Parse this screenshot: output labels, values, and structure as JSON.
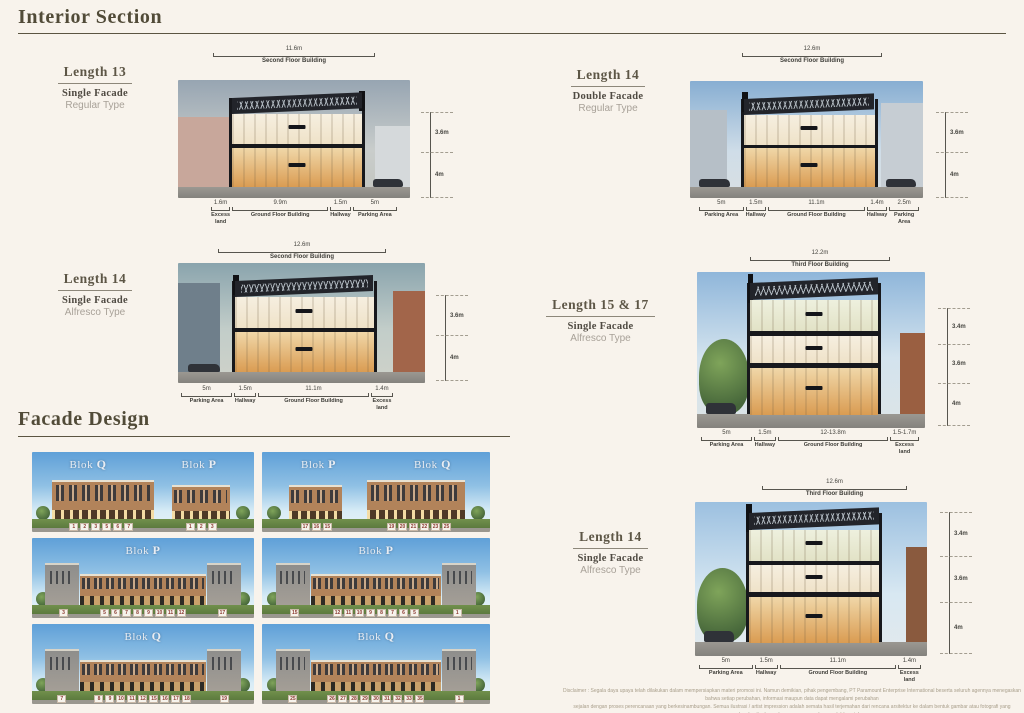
{
  "page": {
    "heading_interior": "Interior Section",
    "heading_facade": "Facade Design",
    "disclaimer_line1": "Disclaimer :  Segala daya upaya telah dilakukan dalam mempersiapkan materi promosi ini. Namun demikian, pihak pengembang, PT Paramount Enterprise International beserta seluruh agennya menegaskan bahwa setiap perubahan, informasi maupun data dapat mengalami perubahan",
    "disclaimer_line2": "sejalan dengan proses perencanaan yang berkesinambungan. Semua ilustrasi / artist impression adalah semata hasil terjemahan dari rencana arsitektur ke dalam bentuk gambar atau fotografi yang merupakan hasil rekaan dengan menggunakan model / contoh."
  },
  "colors": {
    "page_background": "#f8f3ec",
    "heading_text": "#514b38",
    "marker_text": "#8b3a31",
    "sky_blue": "#5fa0d8",
    "grass_green": "#5c7a3e",
    "building_tan": "#b2835a"
  },
  "sections": [
    {
      "length": "Length 13",
      "facade": "Single Facade",
      "type": "Regular Type",
      "top_dim": "11.6m",
      "top_label": "Second Floor Building",
      "right_dims": [
        "3.6m",
        "4m"
      ],
      "bottom": [
        {
          "v": "1.6m",
          "l": "Excess land"
        },
        {
          "v": "9.9m",
          "l": "Ground Floor Building"
        },
        {
          "v": "1.5m",
          "l": "Hallway"
        },
        {
          "v": "5m",
          "l": "Parking Area"
        }
      ]
    },
    {
      "length": "Length 14",
      "facade": "Single Facade",
      "type": "Alfresco Type",
      "top_dim": "12.6m",
      "top_label": "Second Floor Building",
      "right_dims": [
        "3.6m",
        "4m"
      ],
      "bottom": [
        {
          "v": "5m",
          "l": "Parking Area"
        },
        {
          "v": "1.5m",
          "l": "Hallway"
        },
        {
          "v": "11.1m",
          "l": "Ground Floor Building"
        },
        {
          "v": "1.4m",
          "l": "Excess land"
        }
      ]
    },
    {
      "length": "Length 14",
      "facade": "Double Facade",
      "type": "Regular Type",
      "top_dim": "12.6m",
      "top_label": "Second Floor Building",
      "right_dims": [
        "3.6m",
        "4m"
      ],
      "bottom": [
        {
          "v": "5m",
          "l": "Parking Area"
        },
        {
          "v": "1.5m",
          "l": "Hallway"
        },
        {
          "v": "11.1m",
          "l": "Ground Floor Building"
        },
        {
          "v": "1.4m",
          "l": "Hallway"
        },
        {
          "v": "2.5m",
          "l": "Parking Area"
        }
      ]
    },
    {
      "length": "Length 15 & 17",
      "facade": "Single Facade",
      "type": "Alfresco Type",
      "top_dim": "12.2m",
      "top_label": "Third Floor Building",
      "right_dims": [
        "3.4m",
        "3.6m",
        "4m"
      ],
      "bottom": [
        {
          "v": "5m",
          "l": "Parking Area"
        },
        {
          "v": "1.5m",
          "l": "Hallway"
        },
        {
          "v": "12-13.8m",
          "l": "Ground Floor Building"
        },
        {
          "v": "1.5-1.7m",
          "l": "Excess land"
        }
      ]
    },
    {
      "length": "Length 14",
      "facade": "Single Facade",
      "type": "Alfresco Type",
      "top_dim": "12.6m",
      "top_label": "Third Floor Building",
      "right_dims": [
        "3.4m",
        "3.6m",
        "4m"
      ],
      "bottom": [
        {
          "v": "5m",
          "l": "Parking Area"
        },
        {
          "v": "1.5m",
          "l": "Hallway"
        },
        {
          "v": "11.1m",
          "l": "Ground Floor Building"
        },
        {
          "v": "1.4m",
          "l": "Excess land"
        }
      ]
    }
  ],
  "facade": {
    "cards": [
      {
        "bloks": [
          {
            "prefix": "Blok ",
            "letter": "Q"
          },
          {
            "prefix": "Blok ",
            "letter": "P"
          }
        ],
        "markers": [
          [
            "1",
            "2",
            "3",
            "5",
            "6",
            "7"
          ],
          [
            "1",
            "2",
            "3"
          ]
        ]
      },
      {
        "bloks": [
          {
            "prefix": "Blok ",
            "letter": "P"
          },
          {
            "prefix": "Blok ",
            "letter": "Q"
          }
        ],
        "markers": [
          [
            "17",
            "16",
            "15"
          ],
          [
            "19",
            "20",
            "21",
            "22",
            "23",
            "25"
          ]
        ]
      },
      {
        "bloks": [
          {
            "prefix": "Blok ",
            "letter": "P"
          }
        ],
        "markers": [
          [
            "3"
          ],
          [
            "5",
            "6",
            "7",
            "8",
            "9",
            "10",
            "11",
            "12"
          ],
          [
            "17"
          ]
        ]
      },
      {
        "bloks": [
          {
            "prefix": "Blok ",
            "letter": "P"
          }
        ],
        "markers": [
          [
            "15"
          ],
          [
            "12",
            "11",
            "10",
            "9",
            "8",
            "7",
            "6",
            "5"
          ],
          [
            "1"
          ]
        ]
      },
      {
        "bloks": [
          {
            "prefix": "Blok ",
            "letter": "Q"
          }
        ],
        "markers": [
          [
            "7"
          ],
          [
            "8",
            "9",
            "10",
            "11",
            "12",
            "15",
            "16",
            "17",
            "18"
          ],
          [
            "19"
          ]
        ]
      },
      {
        "bloks": [
          {
            "prefix": "Blok ",
            "letter": "Q"
          }
        ],
        "markers": [
          [
            "25"
          ],
          [
            "26",
            "27",
            "28",
            "29",
            "30",
            "31",
            "32",
            "33",
            "35"
          ],
          [
            "1"
          ]
        ]
      }
    ]
  }
}
